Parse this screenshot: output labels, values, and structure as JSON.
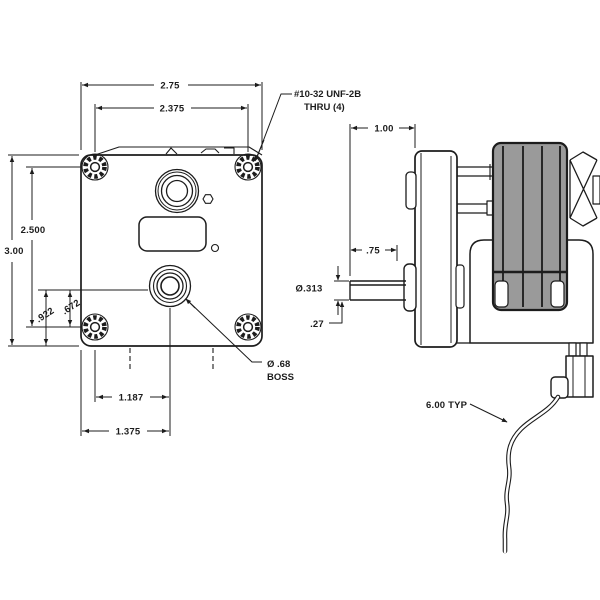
{
  "front": {
    "dims": {
      "overall_width": "2.75",
      "hole_span_h": "2.375",
      "hole_span_v": "2.500",
      "overall_height": "3.00",
      "boss_to_bottom": ".922",
      "boss_to_hole": ".672",
      "boss_offset_from_hole": "1.187",
      "boss_offset_from_edge": "1.375"
    },
    "callouts": {
      "thread_line1": "#10-32 UNF-2B",
      "thread_line2": "THRU (4)",
      "boss_line1": "Ø .68",
      "boss_line2": "BOSS"
    }
  },
  "side": {
    "dims": {
      "shaft_tip_to_face": "1.00",
      "shaft_exposed": ".75",
      "shaft_diameter": "Ø.313",
      "shaft_flat": ".27",
      "lead_length": "6.00 TYP"
    }
  },
  "colors": {
    "line": "#1c1c1c",
    "motor_stack": "#9a9a9a",
    "background": "#ffffff"
  }
}
